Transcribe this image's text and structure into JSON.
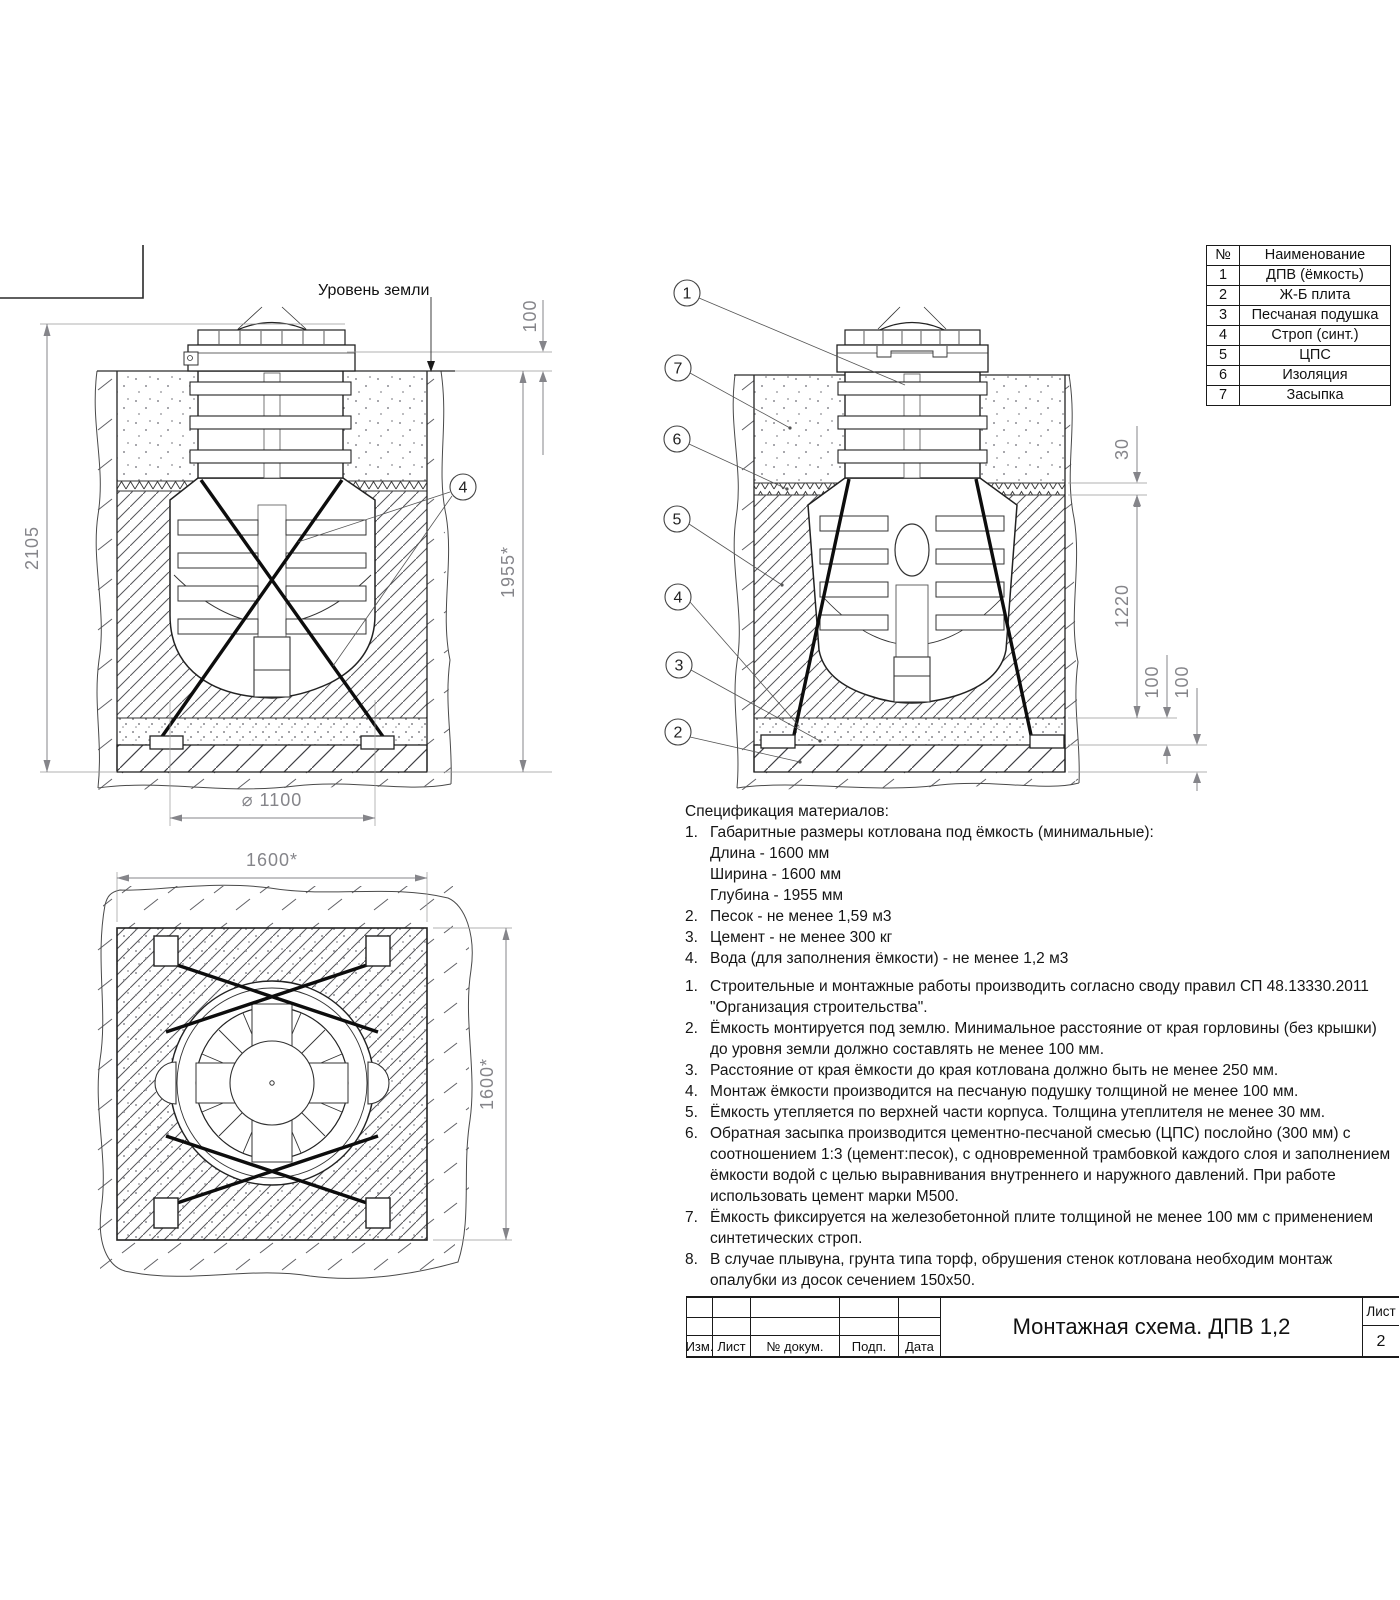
{
  "parts_table": {
    "header_num": "№",
    "header_name": "Наименование",
    "rows": [
      {
        "num": "1",
        "name": "ДПВ (ёмкость)"
      },
      {
        "num": "2",
        "name": "Ж-Б плита"
      },
      {
        "num": "3",
        "name": "Песчаная подушка"
      },
      {
        "num": "4",
        "name": "Строп (синт.)"
      },
      {
        "num": "5",
        "name": "ЦПС"
      },
      {
        "num": "6",
        "name": "Изоляция"
      },
      {
        "num": "7",
        "name": "Засыпка"
      }
    ]
  },
  "left_view": {
    "ground_label": "Уровень земли",
    "dim_neck_to_ground": "100",
    "dim_total_height": "2105",
    "dim_pit_depth": "1955*",
    "dim_diameter": "⌀ 1100",
    "callout_strap": "4"
  },
  "right_view": {
    "callout_tank": "1",
    "callout_backfill": "7",
    "callout_insulation": "6",
    "callout_cps": "5",
    "callout_strap": "4",
    "callout_sand": "3",
    "callout_slab": "2",
    "dim_insulation": "30",
    "dim_body": "1220",
    "dim_sand": "100",
    "dim_slab": "100"
  },
  "top_view": {
    "dim_width": "1600*",
    "dim_length": "1600*"
  },
  "spec": {
    "title": "Спецификация материалов:",
    "materials": [
      {
        "num": "1.",
        "text": "Габаритные размеры котлована под ёмкость (минимальные):",
        "sub": [
          "Длина - 1600 мм",
          "Ширина - 1600 мм",
          "Глубина - 1955 мм"
        ]
      },
      {
        "num": "2.",
        "text": "Песок - не менее 1,59 м3"
      },
      {
        "num": "3.",
        "text": "Цемент - не менее 300 кг"
      },
      {
        "num": "4.",
        "text": "Вода (для заполнения ёмкости) - не менее 1,2 м3"
      }
    ],
    "notes": [
      {
        "num": "1.",
        "text": "Строительные и монтажные работы производить согласно своду правил СП 48.13330.2011 \"Организация строительства\"."
      },
      {
        "num": "2.",
        "text": "Ёмкость монтируется под землю. Минимальное расстояние от края горловины (без крышки) до уровня земли должно составлять не менее 100 мм."
      },
      {
        "num": "3.",
        "text": "Расстояние от края ёмкости до края котлована должно быть не менее 250 мм."
      },
      {
        "num": "4.",
        "text": "Монтаж ёмкости производится на песчаную подушку толщиной не менее 100 мм."
      },
      {
        "num": "5.",
        "text": "Ёмкость утепляется по верхней части корпуса. Толщина утеплителя не менее 30 мм."
      },
      {
        "num": "6.",
        "text": "Обратная засыпка производится цементно-песчаной смесью (ЦПС) послойно (300 мм) с соотношением 1:3 (цемент:песок), с одновременной трамбовкой каждого слоя и заполнением ёмкости водой с целью выравнивания внутреннего и наружного давлений. При работе использовать цемент марки М500."
      },
      {
        "num": "7.",
        "text": "Ёмкость фиксируется на железобетонной плите толщиной не менее 100 мм с применением синтетических строп."
      },
      {
        "num": "8.",
        "text": "В случае плывуна, грунта типа торф, обрушения стенок котлована необходим монтаж опалубки из досок сечением 150х50."
      }
    ]
  },
  "title_block": {
    "title": "Монтажная схема. ДПВ 1,2",
    "col_izm": "Изм.",
    "col_list": "Лист",
    "col_doc": "№ докум.",
    "col_sign": "Подп.",
    "col_date": "Дата",
    "sheet_label": "Лист",
    "sheet_number": "2"
  }
}
